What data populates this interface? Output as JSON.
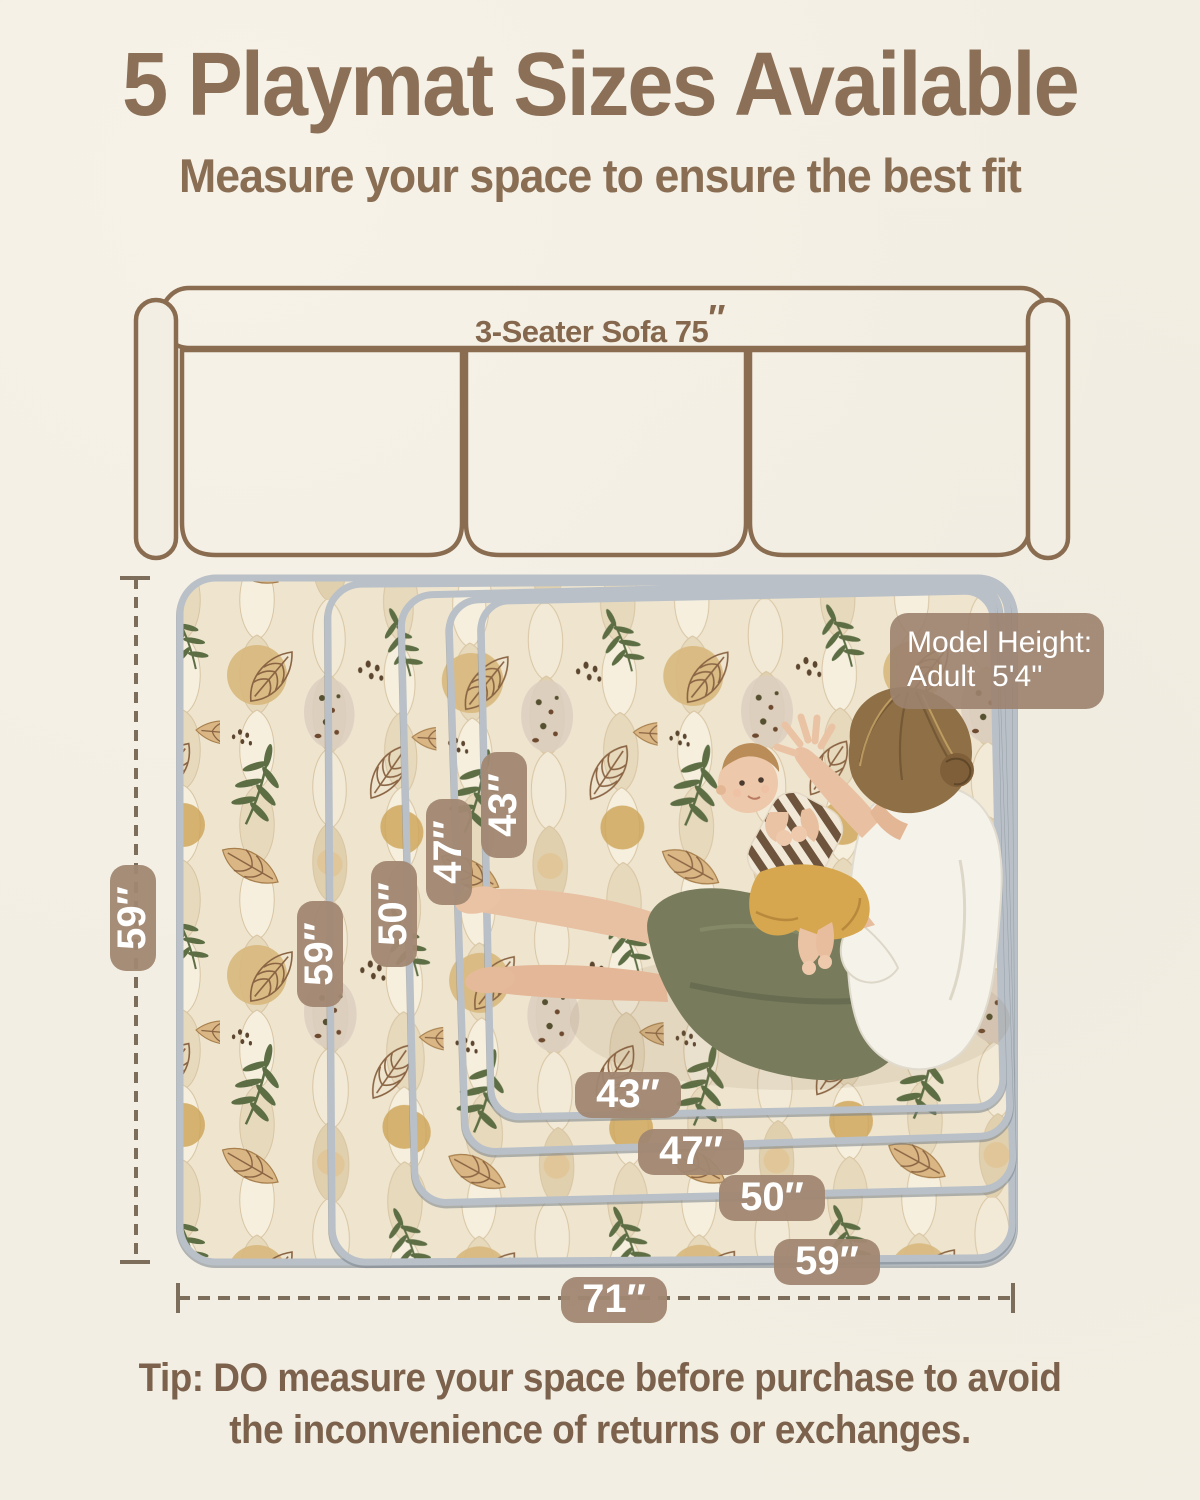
{
  "header": {
    "title": "5 Playmat Sizes Available",
    "subtitle": "Measure your space to ensure the best fit"
  },
  "sofa": {
    "label": "3-Seater Sofa 75",
    "inch_mark": "″"
  },
  "badge": {
    "line1": "Model Height:",
    "line2": "Adult  5'4''"
  },
  "dims": {
    "left_total": "59″",
    "bottom_total": "71″"
  },
  "mat_labels": {
    "vertical": [
      "59″",
      "50″",
      "47″",
      "43″"
    ],
    "horizontal": [
      "43″",
      "47″",
      "50″",
      "59″"
    ]
  },
  "mat_sizes": [
    "71″ × 59″",
    "59″ × 59″",
    "50″ × 50″",
    "47″ × 47″",
    "43″ × 43″"
  ],
  "tip": {
    "line1": "Tip: DO measure your space before purchase to avoid",
    "line2": "the inconvenience of returns or exchanges."
  },
  "colors": {
    "background": "#f2eee3",
    "accent_brown": "#8b6f56",
    "pill_bg": "#a18772",
    "badge_bg": "#9c826e",
    "mat_edge_gray": "#b9c0c7",
    "dash": "#7d6e5b",
    "leaf_green": "#5d6e44"
  }
}
